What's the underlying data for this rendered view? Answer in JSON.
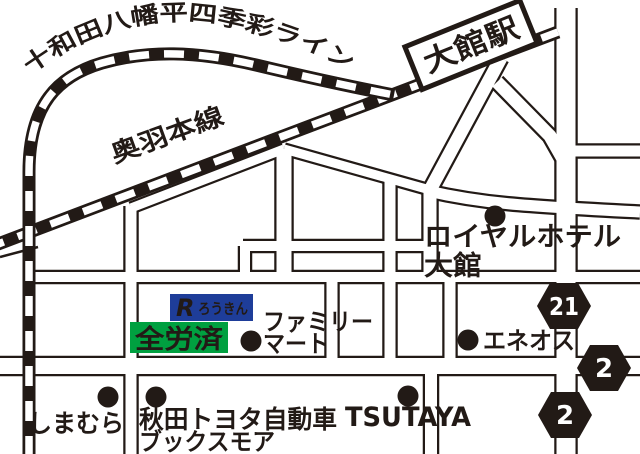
{
  "map": {
    "title": "大館駅周辺地図",
    "railways": {
      "towada_line": {
        "label": "十和田八幡平四季彩ライン"
      },
      "ou_main_line": {
        "label": "奥羽本線"
      }
    },
    "station": {
      "label": "大館駅"
    },
    "route_badges": [
      {
        "number": "21"
      },
      {
        "number": "2"
      },
      {
        "number": "2"
      }
    ],
    "pois": {
      "royal_hotel": {
        "line1": "ロイヤルホテル",
        "line2": "大館"
      },
      "eneos": {
        "label": "エネオス"
      },
      "family_mart": {
        "line1": "ファミリー",
        "line2": "マート"
      },
      "shimamura": {
        "label": "しまむら"
      },
      "akita_toyota": {
        "line1": "秋田トヨタ自動車",
        "line2": "ブックスモア"
      },
      "tsutaya": {
        "label": "TSUTAYA"
      }
    },
    "logos": {
      "rokin": {
        "mark": "R",
        "label": "ろうきん"
      },
      "zenrosai": {
        "label": "全労済"
      }
    },
    "colors": {
      "ink": "#221a16",
      "rokin_blue": "#1e3d99",
      "zenrosai_green": "#00a040"
    }
  }
}
